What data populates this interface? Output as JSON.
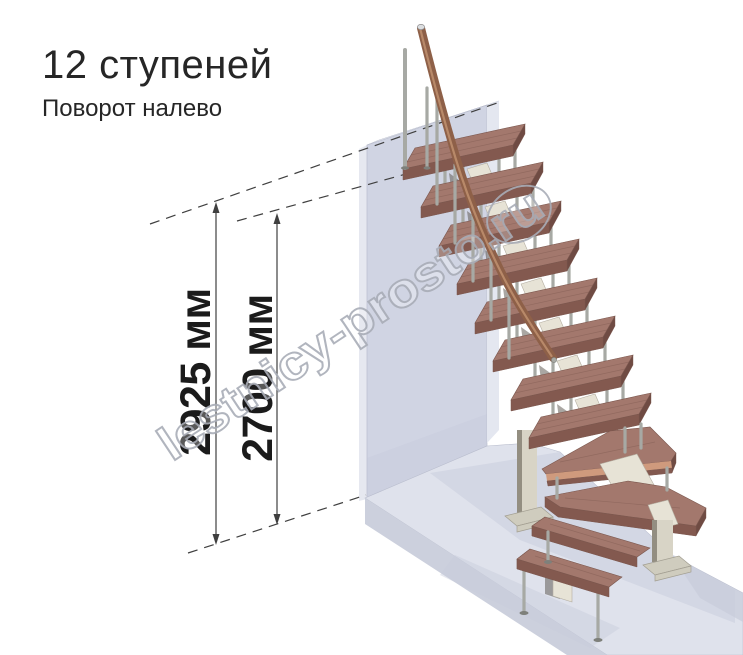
{
  "header": {
    "title": "12 ступеней",
    "subtitle": "Поворот налево"
  },
  "dimensions": [
    {
      "name": "floor-to-floor-height",
      "value": "2925 мм"
    },
    {
      "name": "clear-ceiling-height",
      "value": "2700 мм"
    }
  ],
  "watermark": {
    "text": "lestnicy-prosto.ru"
  },
  "stairs": {
    "steps_total": 12,
    "turn": "left"
  },
  "colors": {
    "background": "#ffffff",
    "text_primary": "#262626",
    "dim_text": "#1b1b1b",
    "dim_line": "#3f3f3f",
    "watermark_stroke": "#a9adb7",
    "wood_top": "#a3786d",
    "wood_front": "#83594f",
    "wood_end": "#6f4b43",
    "wood_stroke": "#7a564d",
    "wood_band": "#cf9a7d",
    "rail": "#8e6048",
    "rail_highlight": "#c09070",
    "rail_dark": "#5e3c2b",
    "metal": "#a7a9a4",
    "metal_dark": "#7e807b",
    "bracket": "#e7e3d6",
    "bracket_shadow": "#554f48",
    "column": "#d8d4c6",
    "column_dark": "#938e81",
    "column_base": "#cfccbe",
    "wall_front": "#d0d4e3",
    "wall_side": "#e4e7f0",
    "wall_top": "#eef0f6",
    "wall_left": "#e6e8f0",
    "wall_outline": "#b9bdcd",
    "floor_top": "#dfe2ec",
    "floor_front": "#ccd0dd",
    "floor_shadow": "#c8ccdb"
  }
}
